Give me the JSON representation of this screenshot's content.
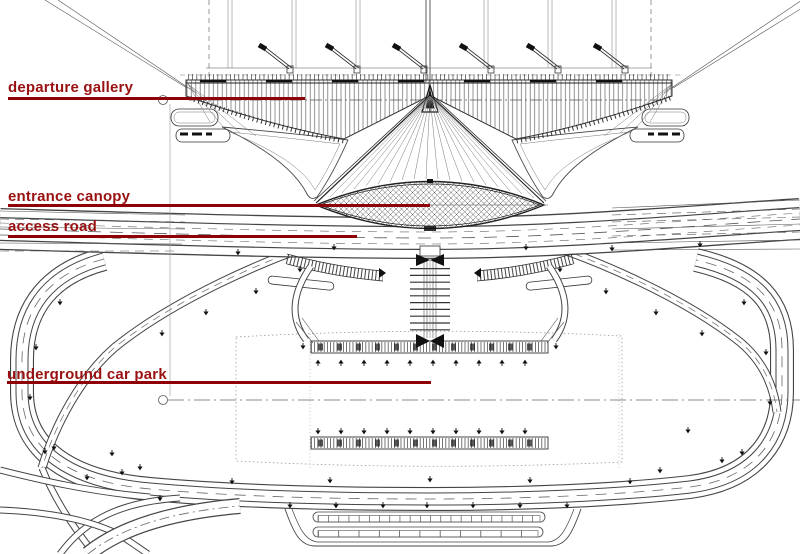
{
  "colors": {
    "annotation_text": "#9a1111",
    "annotation_line": "#8e0005",
    "ink": "#222222",
    "background": "#ffffff"
  },
  "annotations": {
    "items": [
      {
        "id": "departure-gallery",
        "label": "departure gallery"
      },
      {
        "id": "entrance-canopy",
        "label": "entrance canopy"
      },
      {
        "id": "access-road",
        "label": "access road"
      },
      {
        "id": "underground-car-park",
        "label": "underground car park"
      }
    ]
  }
}
